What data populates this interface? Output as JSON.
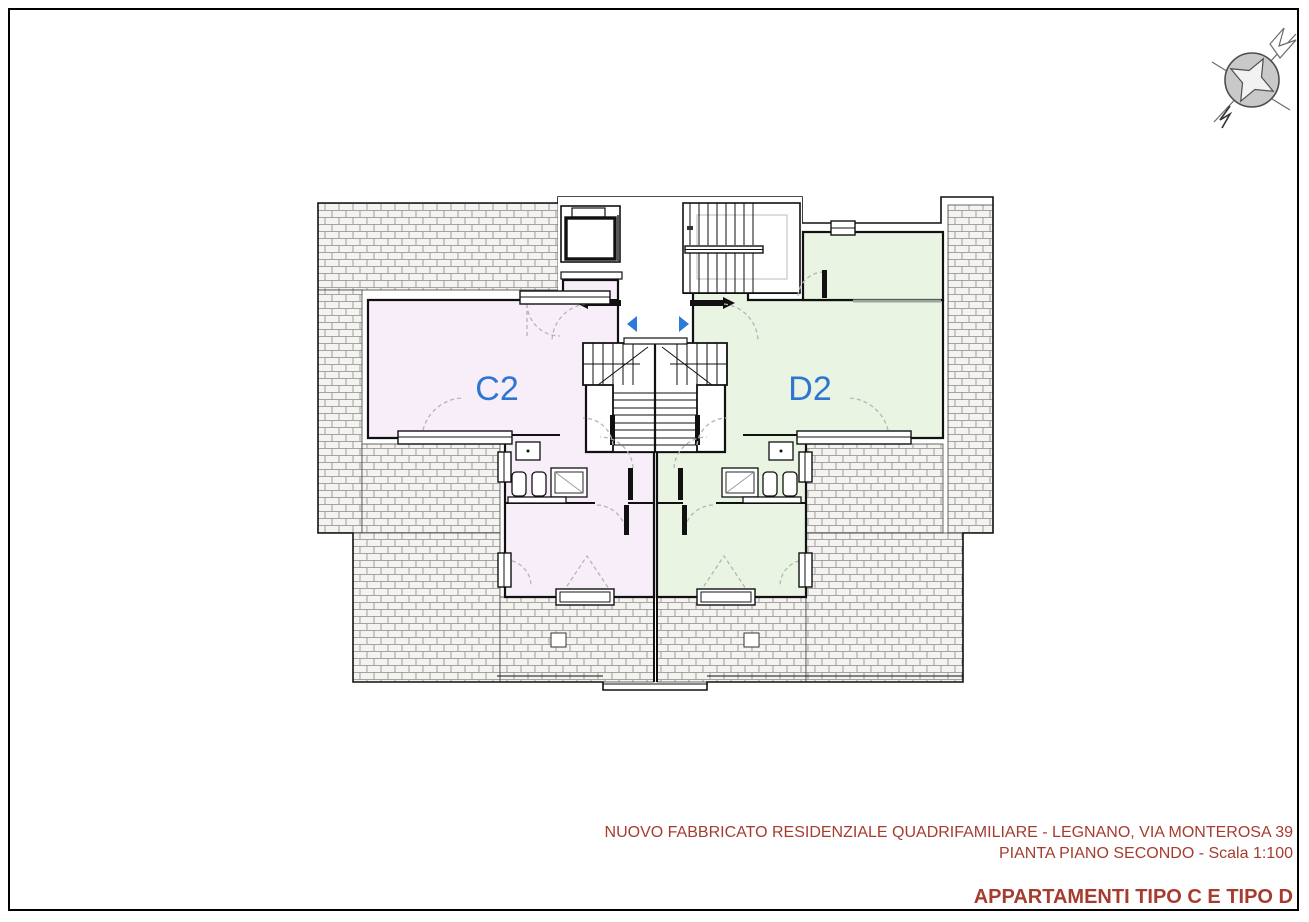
{
  "plan": {
    "apartments": [
      {
        "id": "C2",
        "label": "C2",
        "fill": "#f7eef9",
        "label_color": "#2e76d0"
      },
      {
        "id": "D2",
        "label": "D2",
        "fill": "#e9f4e3",
        "label_color": "#2e76d0"
      }
    ],
    "entrance_arrow_color": "#2d7bd9",
    "wall_color": "#1a1a1a",
    "terrace_hatch_line_color": "#8a8a8a",
    "door_swing_color": "#b5b5b5"
  },
  "title_block": {
    "line1": "NUOVO FABBRICATO RESIDENZIALE QUADRIFAMILIARE - LEGNANO, VIA MONTEROSA 39",
    "line2": "PIANTA PIANO SECONDO - Scala 1:100",
    "line3": "APPARTAMENTI TIPO C E TIPO D",
    "text_color": "#a63c30"
  },
  "compass": {
    "label": "north-arrow"
  }
}
